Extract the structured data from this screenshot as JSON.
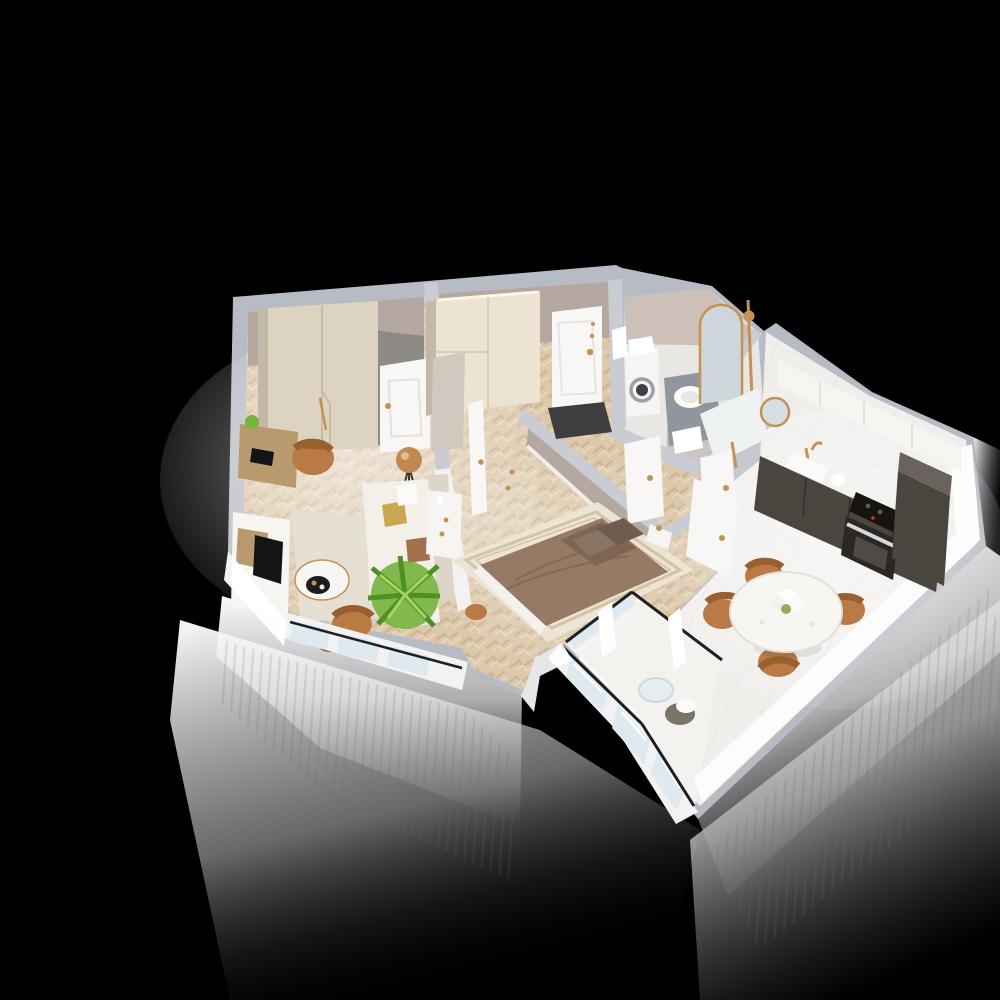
{
  "scene": {
    "kind": "3d-isometric-floorplan-render",
    "description": "Cutaway top-down 3D render of a one-bedroom apartment floating on a black background with glowing white exterior walls",
    "background": "black",
    "text_visible": false
  },
  "palette": {
    "bg": "#000000",
    "wallBand": "#b7bbc3",
    "wallBandIn": "#c9ccd3",
    "wallTaupe": "#b5a8a0",
    "wallTaupeDark": "#8e8a85",
    "wallWhite": "#f2f2f3",
    "floorWood": "#dcc8ab",
    "floorWoodLight": "#ecdcbf",
    "floorWoodDark": "#c5ae8d",
    "floorTile": "#f1efec",
    "floorBath": "#e9e7e3",
    "wardrobe": "#ddd3c1",
    "wardrobeSide": "#c3b9a7",
    "wardrobeLit": "#ece3d2",
    "door": "#f8f7f5",
    "doorShade": "#e4e2de",
    "brass": "#c29355",
    "sofa": "#f3efe9",
    "sofaShade": "#ddd5c9",
    "rug": "#e6dfd4",
    "rugBed": "#ece4d4",
    "rugBorder": "#d3c4a4",
    "bed": "#967a66",
    "bedDark": "#7e6554",
    "pillowDark": "#6e5c4f",
    "chairTan": "#b97a46",
    "chairTanDark": "#98602f",
    "tableWhite": "#f8f6f3",
    "plantGreen": "#76b33c",
    "plantDark": "#4e8f27",
    "plantLight": "#a6d45f",
    "kitchenDark": "#4b4540",
    "kitchenDarkTop": "#6a635d",
    "counter": "#f4f2ee",
    "cooktop": "#17140f",
    "doormat": "#3e3e40",
    "glass": "#dfe9f0",
    "railDark": "#1d1f24",
    "washer": "#f5f5f5",
    "vanity": "#8f969e",
    "deskWood": "#b99a6f",
    "consoleWhite": "#f6f5f2",
    "tv": "#141414",
    "lampCopper": "#c08952"
  },
  "rooms": [
    {
      "name": "Living Room",
      "floor": "herringbone wood",
      "furniture": [
        "wardrobe",
        "interior door",
        "writing desk",
        "laptop",
        "desk chair",
        "tripod floor lamp",
        "media console",
        "tv panel",
        "area rug",
        "white sofa with cushions",
        "round coffee table with tray",
        "palm plant",
        "leather armchair",
        "pouf",
        "french windows"
      ]
    },
    {
      "name": "Hallway",
      "floor": "herringbone wood",
      "furniture": [
        "entry door with brass hardware",
        "dark doormat",
        "hall closet with cove light",
        "leaning mirror",
        "white console"
      ]
    },
    {
      "name": "Bathroom",
      "floor": "stone tile",
      "furniture": [
        "washing machine",
        "towel stack",
        "grey vanity with vessel sink",
        "arched brass mirror",
        "brass shower column",
        "towel rail",
        "white door"
      ]
    },
    {
      "name": "Shower Room",
      "floor": "stone tile",
      "furniture": [
        "round brass mirror",
        "brass shower fittings",
        "white door"
      ]
    },
    {
      "name": "Kitchen",
      "floor": "white tile",
      "furniture": [
        "white upper cabinets",
        "graphite base cabinets",
        "sink with brass faucet",
        "kettle",
        "induction cooktop",
        "built-in oven",
        "tall graphite cabinet",
        "open white door"
      ]
    },
    {
      "name": "Dining Area",
      "floor": "white tile",
      "furniture": [
        "round marble table",
        "flower bouquet",
        "four cognac chairs"
      ]
    },
    {
      "name": "Bedroom",
      "floor": "herringbone wood",
      "furniture": [
        "double bed with brown bedding",
        "dark pillows",
        "bordered rug",
        "white nightstand",
        "tan pouf",
        "open white door"
      ]
    },
    {
      "name": "Balcony",
      "floor": "light tile",
      "furniture": [
        "glazed balustrade windows",
        "dark handrail",
        "round glass table",
        "wicker chair with white cushion"
      ]
    }
  ],
  "lighting": {
    "exterior_glow": "white light spilling from walls fading to black",
    "stripe_falloff": "thin vertical light rays under the south and east facades"
  }
}
